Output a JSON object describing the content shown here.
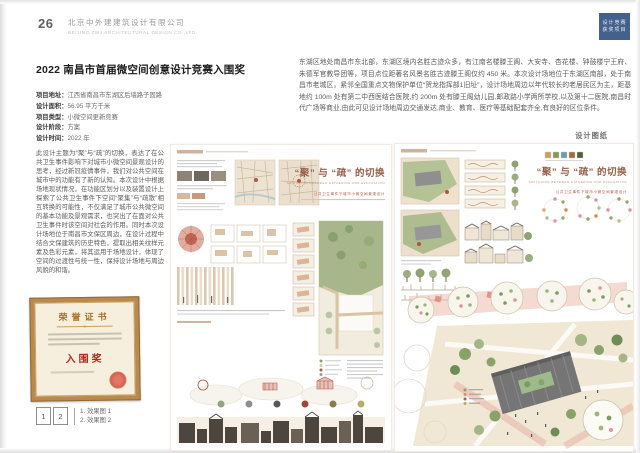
{
  "page": {
    "number": "26",
    "company_cn": "北京中外建建筑设计有限公司",
    "company_en": "BEIJING ZWJ ARCHITECTURAL DESIGN CO.,LTD.",
    "section_tab": {
      "line1": "设计竞赛",
      "line2": "获奖项目",
      "color": "#44618e"
    }
  },
  "title": "2022 南昌市首届微空间创意设计竞赛入围奖",
  "project_info": {
    "items": [
      {
        "label": "项目地址：",
        "value": "江西省南昌市东湖区后墙路子固路"
      },
      {
        "label": "设计面积：",
        "value": "56.95 平方千米"
      },
      {
        "label": "项目类型：",
        "value": "小微空间更新竞赛"
      },
      {
        "label": "设计阶段：",
        "value": "方案"
      },
      {
        "label": "设计时间：",
        "value": "2022 年"
      }
    ]
  },
  "description_left": "此设计主题为“聚”与“疏”的切换，表达了在公共卫生事件影响下对城市小微空间景观设计的思考，经过新冠疫情事件，我们对公共空间在城市中的功能有了新的认知。本次设计中根据场地现状情况，在功能区划分以及装置设计上探索了公共卫生事件下空间“聚集”与“疏散”相互转换的可能性，不仅满足了城市公共微空间的基本功能及景观需求，也突出了在面对公共卫生事件时该空间对社会的作用。同时本次设计场地位于南昌市文保区周边，在设计过程中结合文保建筑的历史特色，提取出相关纹样元素及色彩元素，将其运用于场地设计，体现了空间的过渡性与统一性，保持设计场地与周边风貌的和谐。",
  "description_right": "东湖区地处南昌市东北部，东湖区境内名胜古迹众多，有江南名楼滕王阁、大安寺、杏花楼、钟鼓楼宁王府、朱德军官教导团等，项目点位距著名风景名胜古迹滕王阁仅约 450 米。本次设计场地位于东湖区南部，处于南昌市老城区，紧邻全国重点文物保护单位“贺龙指挥部1旧址”，设计场地周边以年代较长的老居民区为主，距基地约 100m 处有第二中西医结合医院,约 200m 处有滕王阁幼儿园,邮政路小学两所学校,以及第十二医院,南昌时代广场等商业,由此可见设计场地周边交通发达,商业、教育、医疗等基础配套齐全,有良好的区位条件。",
  "drawings_label": "设计图纸",
  "certificate": {
    "title": "荣誉证书",
    "award": "入围奖",
    "accent_red": "#b5281e",
    "border_gold": "#b98a4e"
  },
  "figure_legend": {
    "box1": "1",
    "box2": "2",
    "caption1": "1. 效果图 1",
    "caption2": "2. 效果图 2"
  },
  "posters": {
    "title_cn": "“聚” 与 “疏” 的切换",
    "title_en": "SWITCHING BETWEEN GATHERING AND EVACUATION",
    "subtitle_red": "公共卫生事件下城市小微空间景观设计",
    "title_color": "#96604a",
    "accent_red": "#b95843"
  }
}
